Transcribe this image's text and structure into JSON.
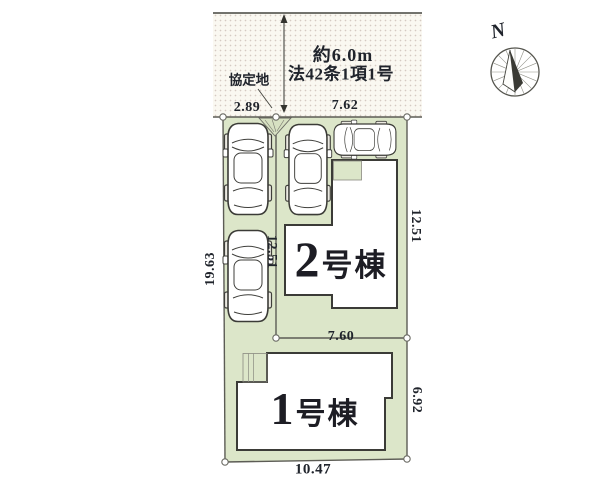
{
  "plan": {
    "road": {
      "width_label": "約6.0m",
      "law_label": "法42条1項1号",
      "agreement_label": "協定地"
    },
    "dimensions": {
      "top_left": "2.89",
      "top_right": "7.62",
      "left_side": "19.63",
      "inner_vertical": "12.51",
      "right_upper": "12.51",
      "middle_horizontal": "7.60",
      "right_lower": "6.92",
      "bottom": "10.47"
    },
    "buildings": [
      {
        "number": "2",
        "suffix": "号棟"
      },
      {
        "number": "1",
        "suffix": "号棟"
      }
    ],
    "compass": {
      "north_label": "N"
    },
    "colors": {
      "lot_green": "#dce6c9",
      "building_fill": "#ffffff",
      "outline_dark": "#3b3b37",
      "boundary_gray": "#5c5c55",
      "text_dark": "#20242c",
      "road_bg": "#faf8f1"
    }
  }
}
